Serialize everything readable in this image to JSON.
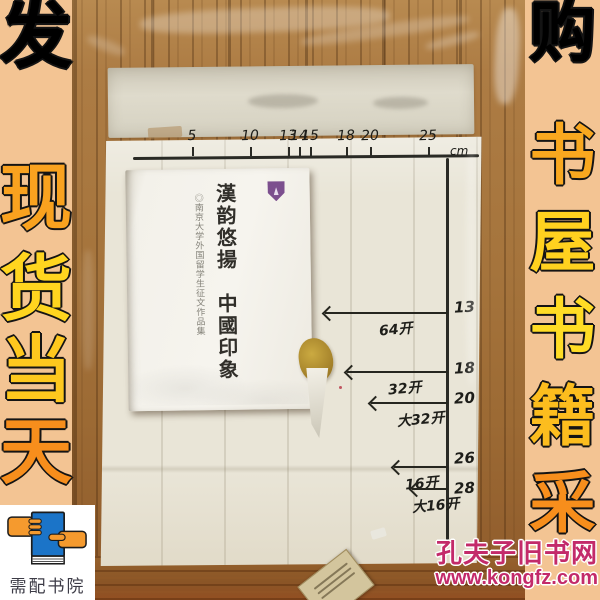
{
  "left_banner": {
    "chars": [
      "现",
      "货",
      "当",
      "天",
      "发"
    ],
    "caption": "需配书院"
  },
  "right_banner": {
    "chars": [
      "书",
      "屋",
      "书",
      "籍",
      "采",
      "购"
    ]
  },
  "watermark": {
    "site_name": "孔夫子旧书网",
    "site_url": "www.kongfz.com"
  },
  "book": {
    "title": "漢韵悠揚　中國印象",
    "subtitle": "◎南京大学外国留学生征文作品集"
  },
  "ruler": {
    "unit_label": "cm",
    "h_ticks": [
      {
        "label": "5",
        "x": 192
      },
      {
        "label": "10",
        "x": 250
      },
      {
        "label": "13",
        "x": 288
      },
      {
        "label": "14",
        "x": 299
      },
      {
        "label": "15",
        "x": 310
      },
      {
        "label": "18",
        "x": 346
      },
      {
        "label": "20",
        "x": 370
      },
      {
        "label": "25",
        "x": 428
      }
    ],
    "v_ticks": [
      {
        "label": "13",
        "y": 307
      },
      {
        "label": "18",
        "y": 368
      },
      {
        "label": "20",
        "y": 398
      },
      {
        "label": "26",
        "y": 458
      },
      {
        "label": "28",
        "y": 488
      }
    ],
    "format_arrows": [
      {
        "label": "64开",
        "y": 313,
        "x_start": 325
      },
      {
        "label": "32开",
        "y": 372,
        "x_start": 347
      },
      {
        "label": "大32开",
        "y": 403,
        "x_start": 371
      },
      {
        "label": "16开",
        "y": 467,
        "x_start": 394
      },
      {
        "label": "大16开",
        "y": 489,
        "x_start": 412
      }
    ]
  },
  "colors": {
    "banner_bg": "#f3c493",
    "char_orange": "#f5871b",
    "char_yellow": "#ffd51f",
    "watermark_magenta": "#c32a6a",
    "logo_blue": "#1b74c8",
    "logo_orange": "#f59a2e"
  }
}
